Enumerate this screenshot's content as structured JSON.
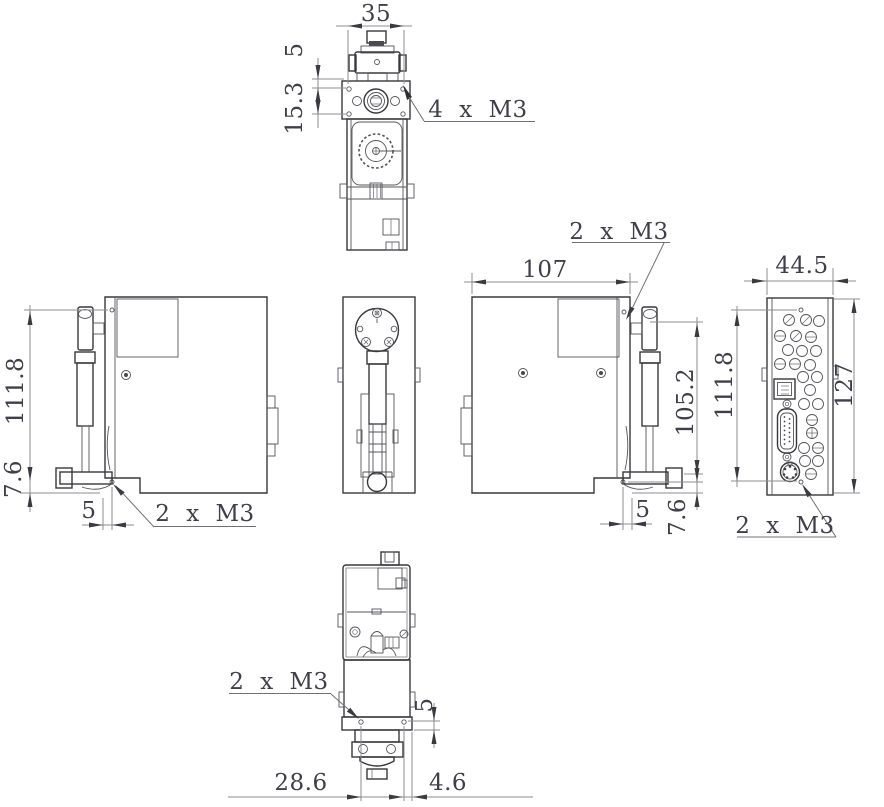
{
  "drawing": {
    "top_view": {
      "dim_width": "35",
      "dim_clamp_offset": "5",
      "dim_hole_pitch": "15.3",
      "note_threads": "4 x M3"
    },
    "left_view": {
      "dim_hole_span": "111.8",
      "dim_bottom": "7.6",
      "dim_edge": "5",
      "note_threads": "2 x M3"
    },
    "right_view": {
      "dim_width": "107",
      "note_threads": "2 x M3",
      "dim_probe": "105.2",
      "dim_edge": "5",
      "dim_bottom": "7.6"
    },
    "rear_view": {
      "dim_width": "44.5",
      "dim_height": "127",
      "dim_hole_span": "111.8",
      "note_threads": "2 x M3"
    },
    "bottom_view": {
      "note_threads": "2 x M3",
      "dim_flange": "5",
      "dim_hole_span": "28.6",
      "dim_edge": "4.6"
    }
  },
  "colors": {
    "background": "#ffffff",
    "outline": "#38383c",
    "inner_line": "#55555a",
    "dimension_line": "#8e8e92",
    "dimension_text": "#3f3f49",
    "arrow": "#3a3a40"
  }
}
